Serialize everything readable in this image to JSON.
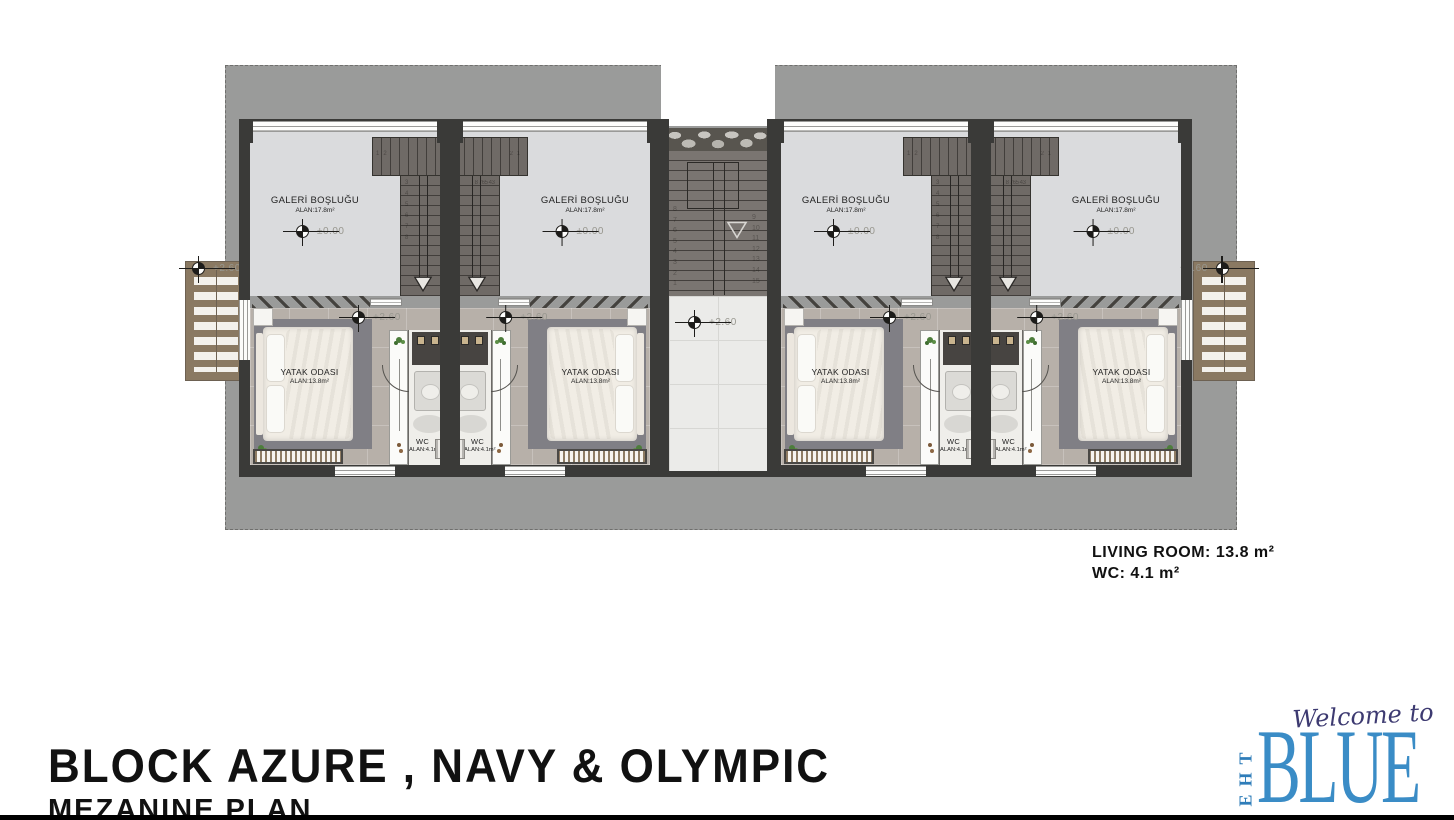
{
  "title_block": {
    "line1": "BLOCK AZURE , NAVY & OLYMPIC",
    "line2": "MEZANINE PLAN"
  },
  "info_block": {
    "lines": [
      "LIVING ROOM: 13.8 m²",
      "WC: 4.1 m²"
    ]
  },
  "logo": {
    "welcome": "Welcome to",
    "the": "THE",
    "blue": "BLUE",
    "blue_color": "#3a8cc6",
    "welcome_color": "#3d3a71"
  },
  "plan": {
    "colors": {
      "terrace_gray": "#9a9b9a",
      "wall_dark": "#3a3a38",
      "gallery_floor": "#dadbdd",
      "bedroom_floor": "#b7b0a9",
      "corridor_floor": "#ebebe9",
      "stair_dark": "#6f6a66",
      "wood": "#8a7962",
      "plant_green": "#4d7d3b"
    },
    "central_core": {
      "corridor_elevation": "+2.60",
      "stair_numbers_left": [
        "8",
        "7",
        "6",
        "5",
        "4",
        "3",
        "2",
        "1"
      ],
      "stair_numbers_right": [
        "9",
        "10",
        "11",
        "12",
        "13",
        "14",
        "15"
      ]
    },
    "external_stairs": [
      {
        "side": "left",
        "elevation": "+2.60"
      },
      {
        "side": "right",
        "elevation": "+2.60"
      }
    ],
    "units": [
      {
        "id": "unit-1",
        "mirrored": false,
        "gallery": {
          "label": "GALERİ BOŞLUĞU",
          "area": "ALAN:17.8m²",
          "elevation": "±0.00"
        },
        "bedroom": {
          "label": "YATAK ODASI",
          "area": "ALAN:13.8m²",
          "elevation": "+2.60"
        },
        "wc": {
          "label": "WC",
          "area": "ALAN:4.1m²"
        },
        "stair_bar_numbers": [
          "1",
          "2"
        ],
        "stair_run_numbers": [
          "3",
          "4",
          "5",
          "6",
          "7",
          "8"
        ]
      },
      {
        "id": "unit-2",
        "mirrored": true,
        "gallery": {
          "label": "GALERİ BOŞLUĞU",
          "area": "ALAN:17.8m²",
          "elevation": "±0.00"
        },
        "bedroom": {
          "label": "YATAK ODASI",
          "area": "ALAN:13.8m²",
          "elevation": "+2.60"
        },
        "wc": {
          "label": "WC",
          "area": "ALAN:4.1m²"
        },
        "stair_bar_numbers": [
          "1",
          "2"
        ],
        "stair_run_numbers": [
          "3",
          "4",
          "5",
          "6",
          "7",
          "8"
        ]
      },
      {
        "id": "unit-3",
        "mirrored": false,
        "gallery": {
          "label": "GALERİ BOŞLUĞU",
          "area": "ALAN:17.8m²",
          "elevation": "±0.00"
        },
        "bedroom": {
          "label": "YATAK ODASI",
          "area": "ALAN:13.8m²",
          "elevation": "+2.60"
        },
        "wc": {
          "label": "WC",
          "area": "ALAN:4.1m²"
        },
        "stair_bar_numbers": [
          "1",
          "2"
        ],
        "stair_run_numbers": [
          "3",
          "4",
          "5",
          "6",
          "7",
          "8"
        ]
      },
      {
        "id": "unit-4",
        "mirrored": true,
        "gallery": {
          "label": "GALERİ BOŞLUĞU",
          "area": "ALAN:17.8m²",
          "elevation": "±0.00"
        },
        "bedroom": {
          "label": "YATAK ODASI",
          "area": "ALAN:13.8m²",
          "elevation": "+2.60"
        },
        "wc": {
          "label": "WC",
          "area": "ALAN:4.1m²"
        },
        "stair_bar_numbers": [
          "1",
          "2"
        ],
        "stair_run_numbers": [
          "3",
          "4",
          "5",
          "6",
          "7",
          "8"
        ]
      }
    ]
  }
}
